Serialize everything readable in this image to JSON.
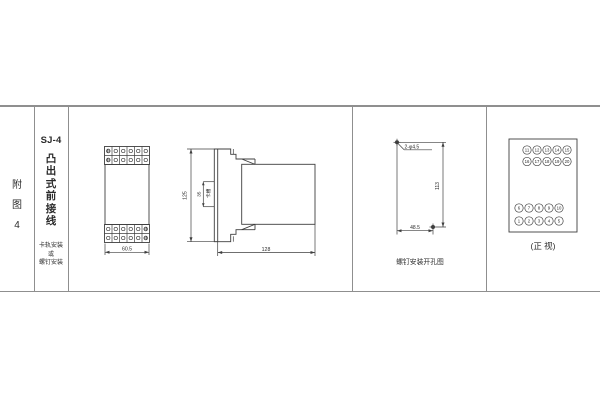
{
  "colors": {
    "line": "#3f3f3f",
    "table_border": "#8f8f8f",
    "text": "#2b2b2b",
    "background": "#ffffff"
  },
  "title_block": {
    "figure_chars": [
      "附",
      "图",
      "4"
    ]
  },
  "spec_block": {
    "model": "SJ-4",
    "type_chars": [
      "凸",
      "出",
      "式",
      "前",
      "接",
      "线"
    ],
    "mounting_lines": [
      "卡轨安装",
      "或",
      "螺钉安装"
    ]
  },
  "front_view": {
    "width_dim": "60.5"
  },
  "side_view": {
    "height_dim": "125",
    "slot_dim": "35",
    "slot_label": "卡槽",
    "depth_dim": "128"
  },
  "drill_view": {
    "hole_label": "2-φ4.5",
    "vertical_dim": "113",
    "horizontal_dim": "48.5",
    "caption": "螺钉安装开孔图"
  },
  "terminal_view": {
    "caption": "(正 视)",
    "rows": [
      {
        "values": [
          "11",
          "12",
          "13",
          "14",
          "15"
        ]
      },
      {
        "values": [
          "16",
          "17",
          "18",
          "19",
          "20"
        ]
      },
      {
        "values": [
          "6",
          "7",
          "8",
          "9",
          "10"
        ]
      },
      {
        "values": [
          "1",
          "2",
          "3",
          "4",
          "5"
        ]
      }
    ]
  }
}
